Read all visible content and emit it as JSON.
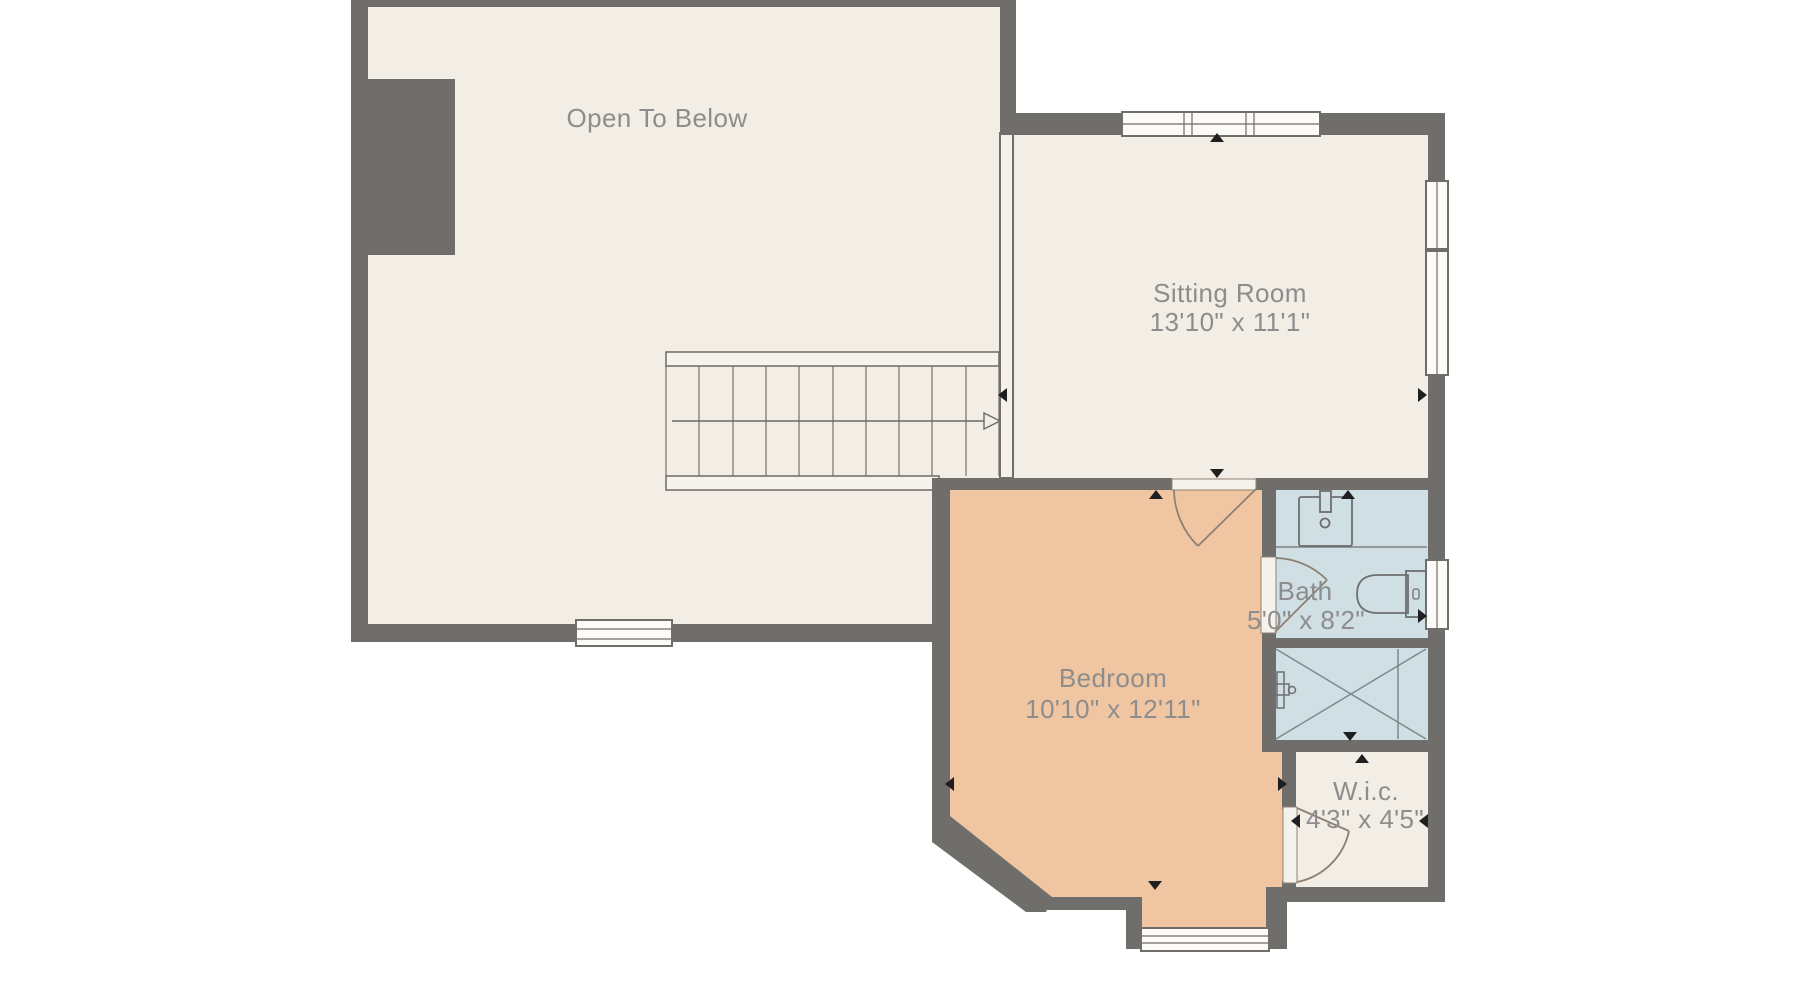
{
  "floor_plan": {
    "type": "residential-floor-plan",
    "rooms": {
      "open_to_below": {
        "name": "Open To Below",
        "dimensions": ""
      },
      "sitting_room": {
        "name": "Sitting Room",
        "dimensions": "13'10\" x 11'1\""
      },
      "bedroom": {
        "name": "Bedroom",
        "dimensions": "10'10\" x 12'11\""
      },
      "bath": {
        "name": "Bath",
        "dimensions": "5'0\" x 8'2\""
      },
      "walk_in_closet": {
        "name": "W.i.c.",
        "dimensions": "4'3\" x 4'5\""
      }
    },
    "fixtures": [
      "staircase-up-arrow",
      "vanity-sink",
      "toilet",
      "shower-stall",
      "shower-valve",
      "chimney"
    ],
    "window_count": 6,
    "door_count": 3,
    "palette": {
      "background": "#ffffff",
      "wall": "#706e6b",
      "floor": "#f2ede5",
      "bedroom_floor": "#f0c6a2",
      "bath_floor": "#cfdfe4",
      "window_fill": "#fcfbf8",
      "door_fill": "#f5f2ec",
      "door_arc": "#8f8074",
      "stair_line": "#8b8378",
      "marker": "#1f1f1f",
      "label_text": "#8d8d8d"
    }
  }
}
